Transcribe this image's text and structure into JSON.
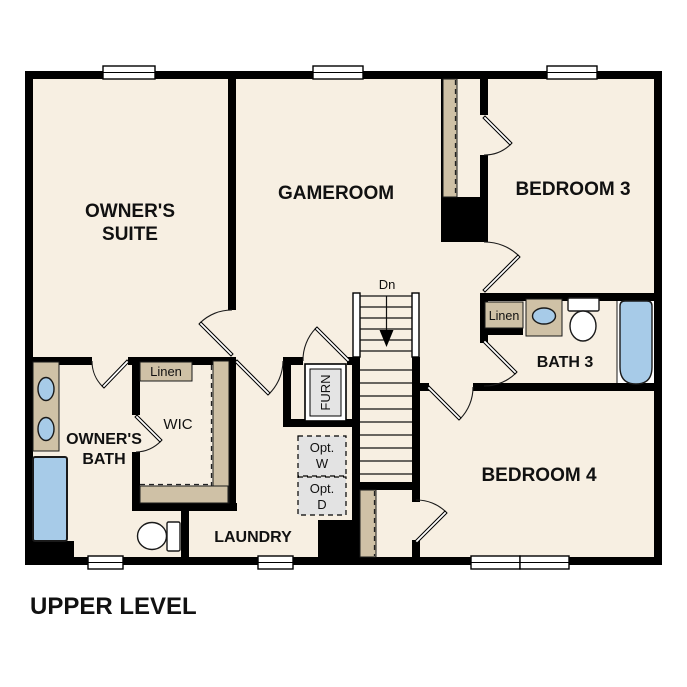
{
  "plan_title": "UPPER LEVEL",
  "rooms": {
    "owners_suite": {
      "line1": "OWNER'S",
      "line2": "SUITE"
    },
    "gameroom": {
      "label": "GAMEROOM"
    },
    "bedroom3": {
      "label": "BEDROOM 3"
    },
    "bedroom4": {
      "label": "BEDROOM 4"
    },
    "bath3": {
      "label": "BATH 3"
    },
    "owners_bath": {
      "line1": "OWNER'S",
      "line2": "BATH"
    },
    "wic": {
      "label": "WIC"
    },
    "laundry": {
      "label": "LAUNDRY"
    },
    "linen_hall": {
      "label": "Linen"
    },
    "linen_bath3": {
      "label": "Linen"
    }
  },
  "stairs": {
    "direction_label": "Dn"
  },
  "utility": {
    "furnace": {
      "label": "FURN"
    },
    "opt_washer": {
      "line1": "Opt.",
      "line2": "W"
    },
    "opt_dryer": {
      "line1": "Opt.",
      "line2": "D"
    }
  },
  "colors": {
    "floor": "#f7efe2",
    "wall": "#000000",
    "casework": "#cfc1a6",
    "fixture": "#a7cbe8",
    "optional_grey": "#e3e3e3",
    "furnace_grey": "#e4e4e4",
    "tub_alcove": "#ffffff"
  }
}
